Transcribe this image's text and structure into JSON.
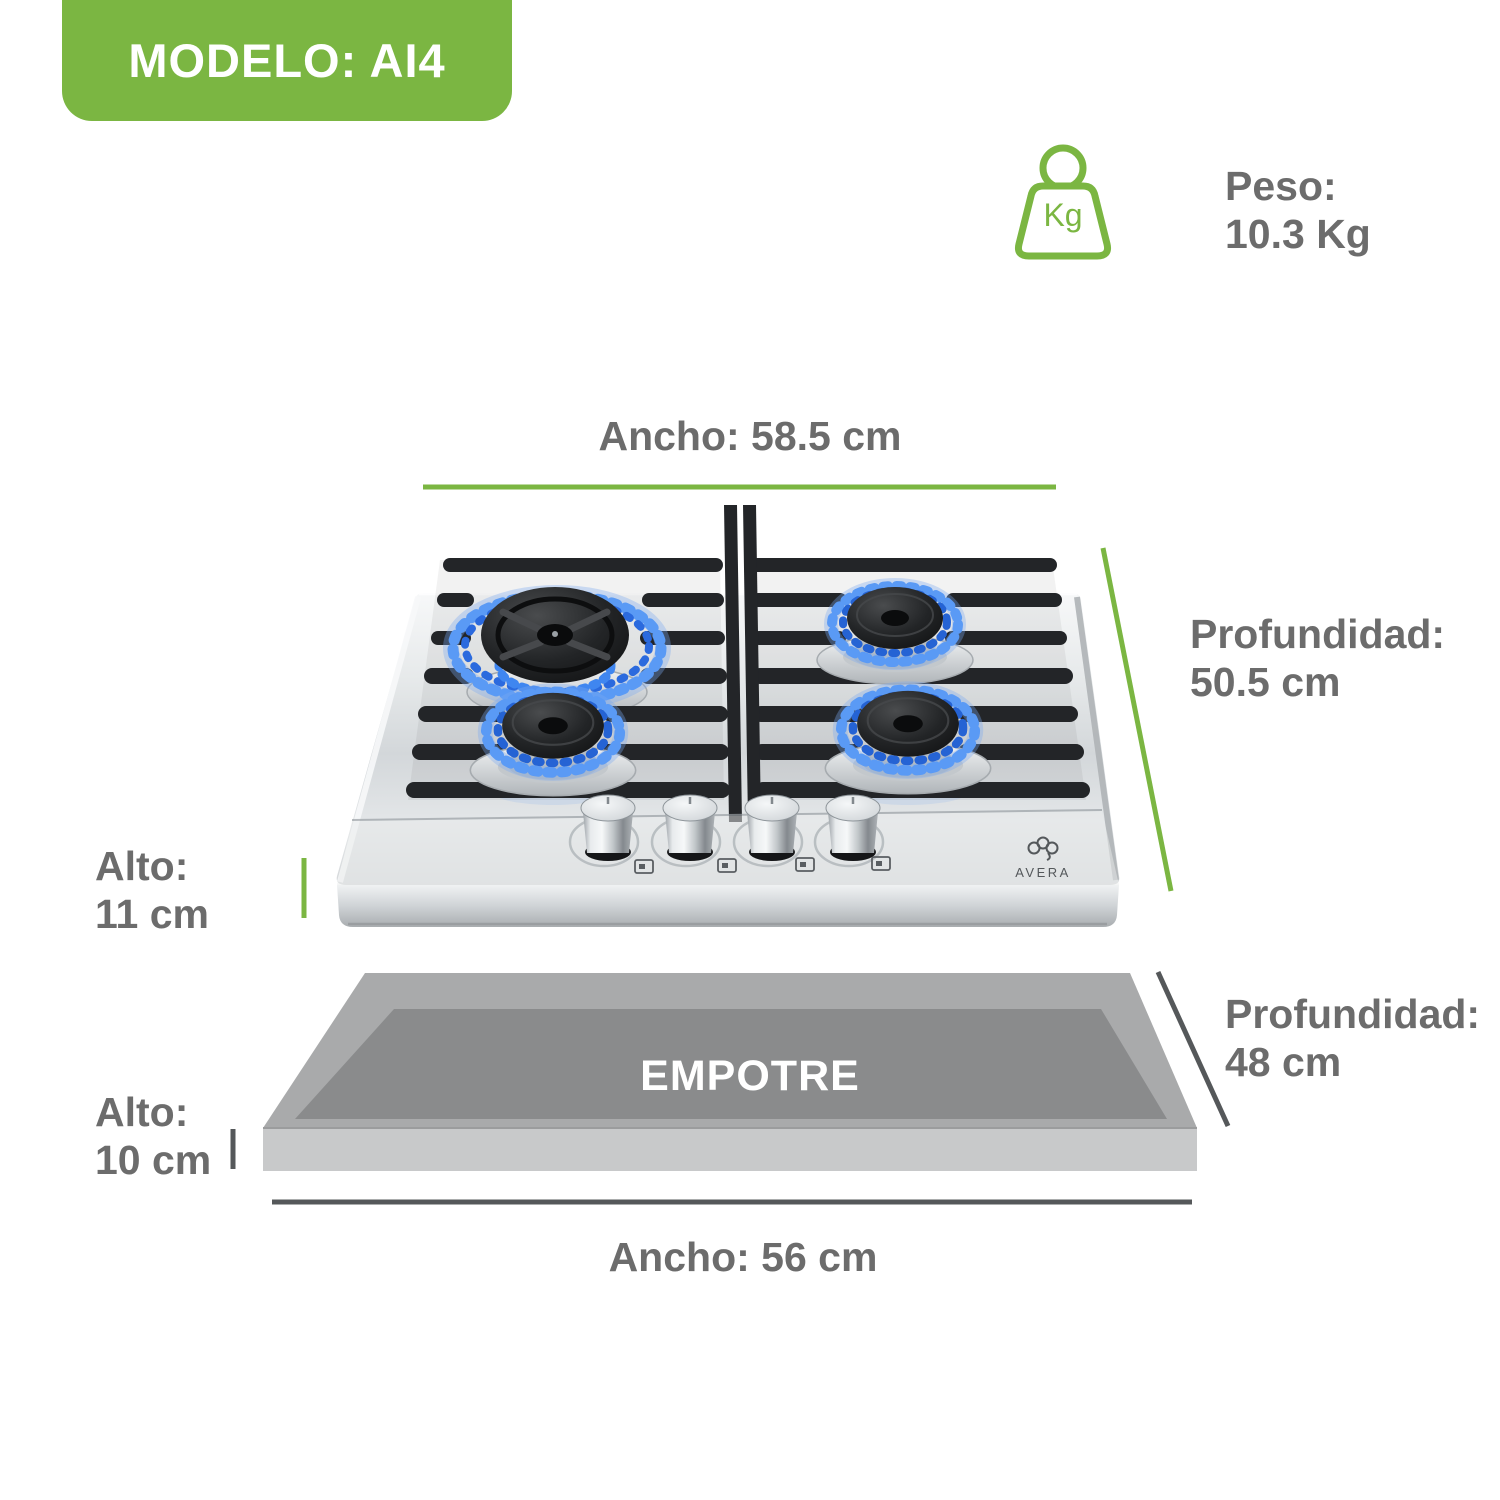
{
  "badge": {
    "label": "MODELO: AI4"
  },
  "weight": {
    "unit_label": "Kg",
    "title": "Peso:",
    "value": "10.3 Kg"
  },
  "cooktop": {
    "brand": "AVERA",
    "burner_count": 4,
    "knob_count": 4,
    "dimensions": {
      "width_label": "Ancho: 58.5 cm",
      "depth_title": "Profundidad:",
      "depth_value": "50.5 cm",
      "height_title": "Alto:",
      "height_value": "11 cm"
    }
  },
  "cutout": {
    "label": "EMPOTRE",
    "dimensions": {
      "depth_title": "Profundidad:",
      "depth_value": "48 cm",
      "height_title": "Alto:",
      "height_value": "10 cm",
      "width_label": "Ancho: 56 cm"
    }
  },
  "colors": {
    "accent_green": "#7bb642",
    "text_gray": "#6c6c6c",
    "dim_line_dark": "#55585a",
    "flame_blue": "#3d7ee8",
    "cutout_top": "#a9aaab",
    "cutout_inner": "#8a8b8c",
    "cutout_front": "#c8c9ca"
  }
}
